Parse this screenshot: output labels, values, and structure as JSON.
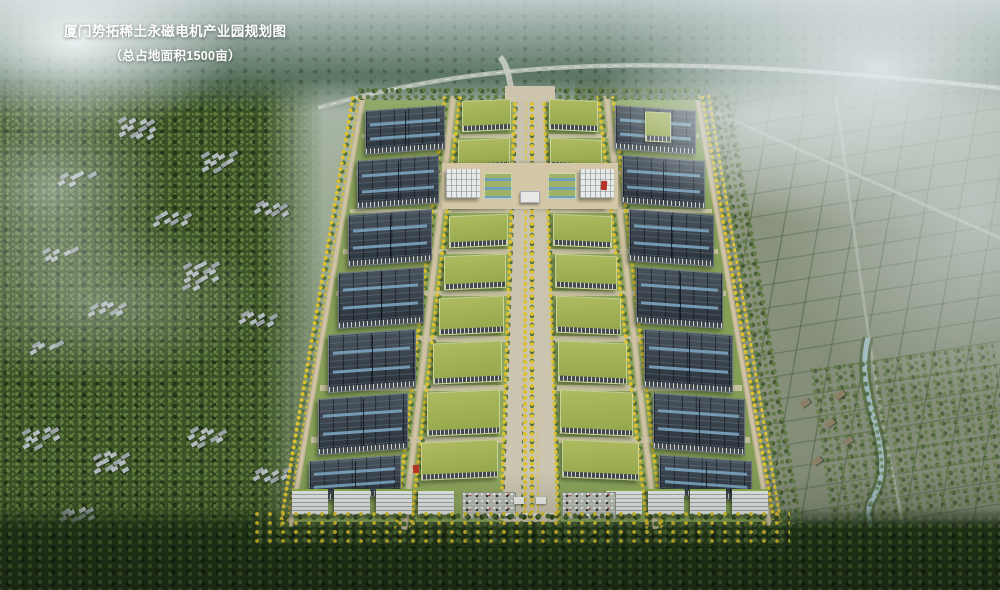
{
  "title_block": {
    "line1": "厦门势拓稀土永磁电机产业园规划图",
    "line2": "（总占地面积1500亩）"
  },
  "palette": {
    "fog": "#e2eaec",
    "haze_blue": "#c4d0d4",
    "forest_dark": "#243619",
    "forest_mid": "#3c5226",
    "forest_light": "#5e7a3c",
    "field_gray_green": "#8d967f",
    "park_grass": "#86a055",
    "road_tan": "#cfc2a3",
    "axis_gray": "#c9c4b2",
    "pv_roof": "#333e49",
    "pv_skylight": "#7fa9c4",
    "green_roof": "#a2b254",
    "facade_dark": "#43494d",
    "facade_white": "#e4e8e6",
    "tree_yellow": "#ddc22e",
    "tree_green": "#55703a",
    "pool_blue": "#6fa0b5",
    "water": "#a3bfc6",
    "village_gray": "#b4bbbf",
    "accent_red": "#b43226"
  },
  "park": {
    "axis_x": 530,
    "top_y": 100,
    "bottom_y": 522,
    "west_top_x": 362,
    "west_bottom_x": 291,
    "east_top_x": 699,
    "east_bottom_x": 771,
    "axis_half_top": 14,
    "axis_half_bottom": 26,
    "sidewalk_top": 4,
    "sidewalk_bottom": 8,
    "inner_width_top": 48,
    "inner_width_bottom": 82,
    "road_gap_top": 15,
    "road_gap_bottom": 19,
    "inner_rows": [
      [
        100,
        31
      ],
      [
        139,
        30
      ],
      [
        177,
        30
      ],
      [
        215,
        32
      ],
      [
        255,
        34
      ],
      [
        297,
        37
      ],
      [
        342,
        41
      ],
      [
        391,
        44
      ],
      [
        441,
        38
      ]
    ],
    "outer_rows": [
      [
        108,
        44
      ],
      [
        158,
        48
      ],
      [
        212,
        52
      ],
      [
        270,
        56
      ],
      [
        332,
        58
      ],
      [
        396,
        56
      ],
      [
        458,
        40
      ]
    ],
    "cross_roads_y": [
      134,
      171,
      209,
      249,
      291,
      336,
      385,
      437
    ],
    "offices_left_x": [
      292,
      334,
      376,
      418
    ],
    "offices_right_x": [
      606,
      648,
      690,
      732
    ],
    "office_y": 489,
    "office_w": 36,
    "office_h": 26
  },
  "background": {
    "village_clusters": [
      {
        "x": 118,
        "y": 118,
        "n": 12
      },
      {
        "x": 200,
        "y": 152,
        "n": 10
      },
      {
        "x": 58,
        "y": 172,
        "n": 6
      },
      {
        "x": 152,
        "y": 212,
        "n": 8
      },
      {
        "x": 252,
        "y": 202,
        "n": 8
      },
      {
        "x": 42,
        "y": 248,
        "n": 6
      },
      {
        "x": 182,
        "y": 262,
        "n": 14
      },
      {
        "x": 88,
        "y": 302,
        "n": 8
      },
      {
        "x": 238,
        "y": 312,
        "n": 8
      },
      {
        "x": 28,
        "y": 342,
        "n": 5
      },
      {
        "x": 22,
        "y": 428,
        "n": 10
      },
      {
        "x": 92,
        "y": 452,
        "n": 12
      },
      {
        "x": 188,
        "y": 428,
        "n": 10
      },
      {
        "x": 252,
        "y": 468,
        "n": 8
      },
      {
        "x": 58,
        "y": 508,
        "n": 8
      }
    ],
    "hamlet_east": [
      {
        "x": 800,
        "y": 400
      },
      {
        "x": 825,
        "y": 420
      },
      {
        "x": 843,
        "y": 438
      },
      {
        "x": 812,
        "y": 458
      },
      {
        "x": 835,
        "y": 392
      }
    ]
  }
}
